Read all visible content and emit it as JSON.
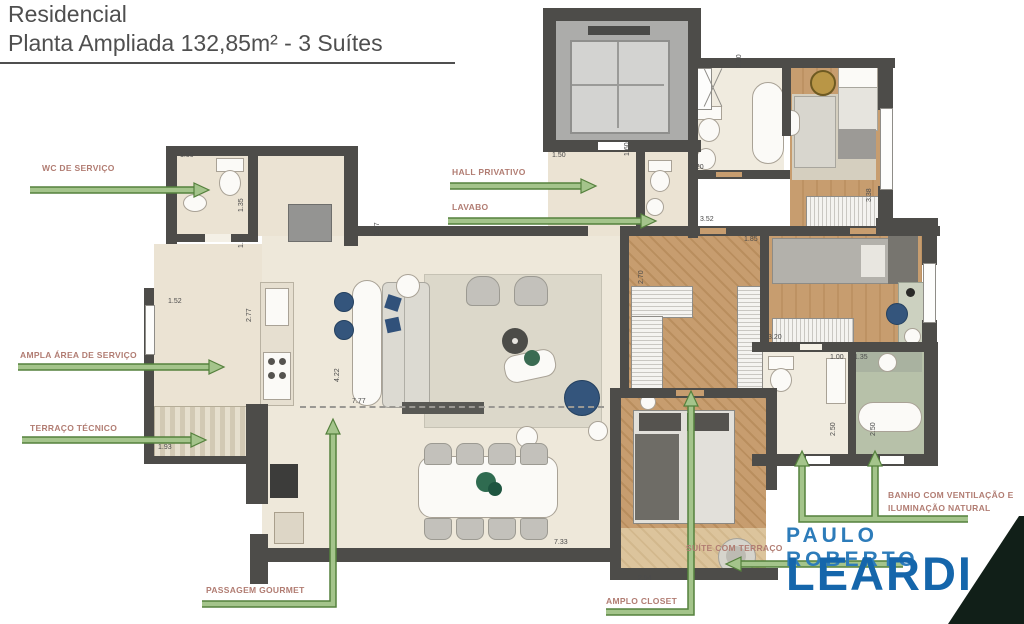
{
  "title": {
    "line1": "Residencial",
    "line2": "Planta Ampliada 132,85m² - 3 Suítes"
  },
  "labels": {
    "wc_servico": "WC DE SERVIÇO",
    "area_servico": "AMPLA ÁREA DE SERVIÇO",
    "terraco_tecnico": "TERRAÇO TÉCNICO",
    "passagem_gourmet": "PASSAGEM GOURMET",
    "hall_privativo": "HALL PRIVATIVO",
    "lavabo": "LAVABO",
    "amplo_closet": "AMPLO CLOSET",
    "suite_terraco": "SUÍTE COM TERRAÇO",
    "banho_line1": "BANHO COM VENTILAÇÃO E",
    "banho_line2": "ILUMINAÇÃO NATURAL"
  },
  "dimensions": [
    {
      "v": "1.50",
      "x": 180,
      "y": 152
    },
    {
      "v": "1.35",
      "x": 238,
      "y": 212,
      "r": true
    },
    {
      "v": "1.76",
      "x": 238,
      "y": 248,
      "r": true
    },
    {
      "v": "2.77",
      "x": 246,
      "y": 322,
      "r": true
    },
    {
      "v": "1.52",
      "x": 168,
      "y": 298
    },
    {
      "v": "1.93",
      "x": 158,
      "y": 444
    },
    {
      "v": "3.57",
      "x": 374,
      "y": 236,
      "r": true
    },
    {
      "v": "4.22",
      "x": 334,
      "y": 382,
      "r": true
    },
    {
      "v": "7.77",
      "x": 352,
      "y": 398
    },
    {
      "v": "1.50",
      "x": 552,
      "y": 152
    },
    {
      "v": "1.60",
      "x": 624,
      "y": 156,
      "r": true
    },
    {
      "v": "2.30",
      "x": 736,
      "y": 68,
      "r": true
    },
    {
      "v": "1.20",
      "x": 690,
      "y": 164
    },
    {
      "v": "3.52",
      "x": 700,
      "y": 216
    },
    {
      "v": "1.85",
      "x": 744,
      "y": 236
    },
    {
      "v": "3.38",
      "x": 866,
      "y": 202,
      "r": true
    },
    {
      "v": "2.70",
      "x": 638,
      "y": 284,
      "r": true
    },
    {
      "v": "3.20",
      "x": 768,
      "y": 334
    },
    {
      "v": "1.00",
      "x": 830,
      "y": 354
    },
    {
      "v": "1.35",
      "x": 854,
      "y": 354
    },
    {
      "v": "2.50",
      "x": 830,
      "y": 436,
      "r": true
    },
    {
      "v": "2.50",
      "x": 870,
      "y": 436,
      "r": true
    },
    {
      "v": "7.33",
      "x": 554,
      "y": 539
    },
    {
      "v": "2.54",
      "x": 638,
      "y": 575
    }
  ],
  "logo": {
    "line1": "PAULO ROBERTO",
    "line2": "LEARDI"
  },
  "colors": {
    "label_text": "#b17c72",
    "arrow_green_edge": "#55813d",
    "arrow_green_fill": "#a4c48b",
    "wall": "#4d4c49",
    "floor_cream": "#ebe3d3",
    "wood": "#c79d6f",
    "sage_bath": "#b7c1a9",
    "logo_blue_light": "#2d7cba",
    "logo_blue_dark": "#1566ab",
    "corner_triangle": "#111f18"
  }
}
